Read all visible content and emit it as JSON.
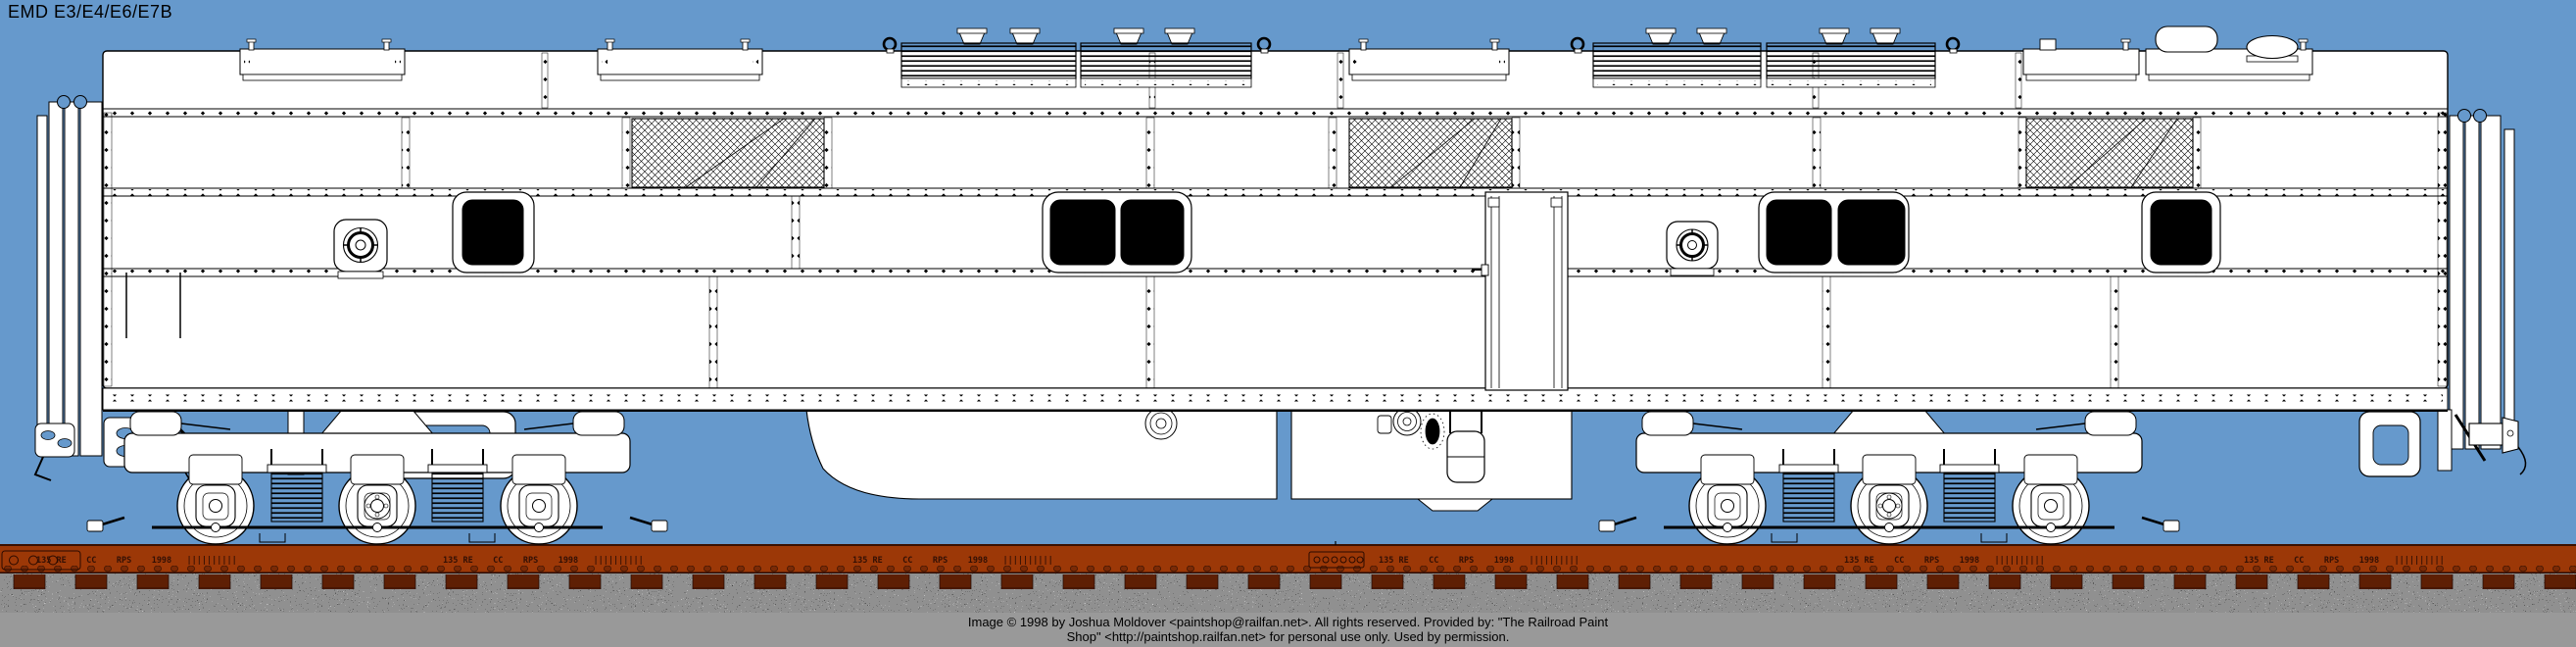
{
  "header": {
    "title": "EMD E3/E4/E6/E7B"
  },
  "track": {
    "rail_marking": "135 RE    CC    RPS    1998   ||||||||||"
  },
  "footer": {
    "line1": "Image  © 1998 by Joshua Moldover <paintshop@railfan.net>.  All rights reserved.  Provided by: \"The Railroad Paint",
    "line2": "Shop\" <http://paintshop.railfan.net> for personal use only.  Used by permission."
  },
  "colors": {
    "background": "#6699CC",
    "body_white": "#FFFFFF",
    "line_black": "#000000",
    "rail_brown": "#9C3807",
    "tie_brown": "#5E1F04",
    "ballast_gray": "#909090",
    "footer_bar_gray": "#999999",
    "glass_black": "#000000",
    "rail_text_color": "#331005"
  }
}
